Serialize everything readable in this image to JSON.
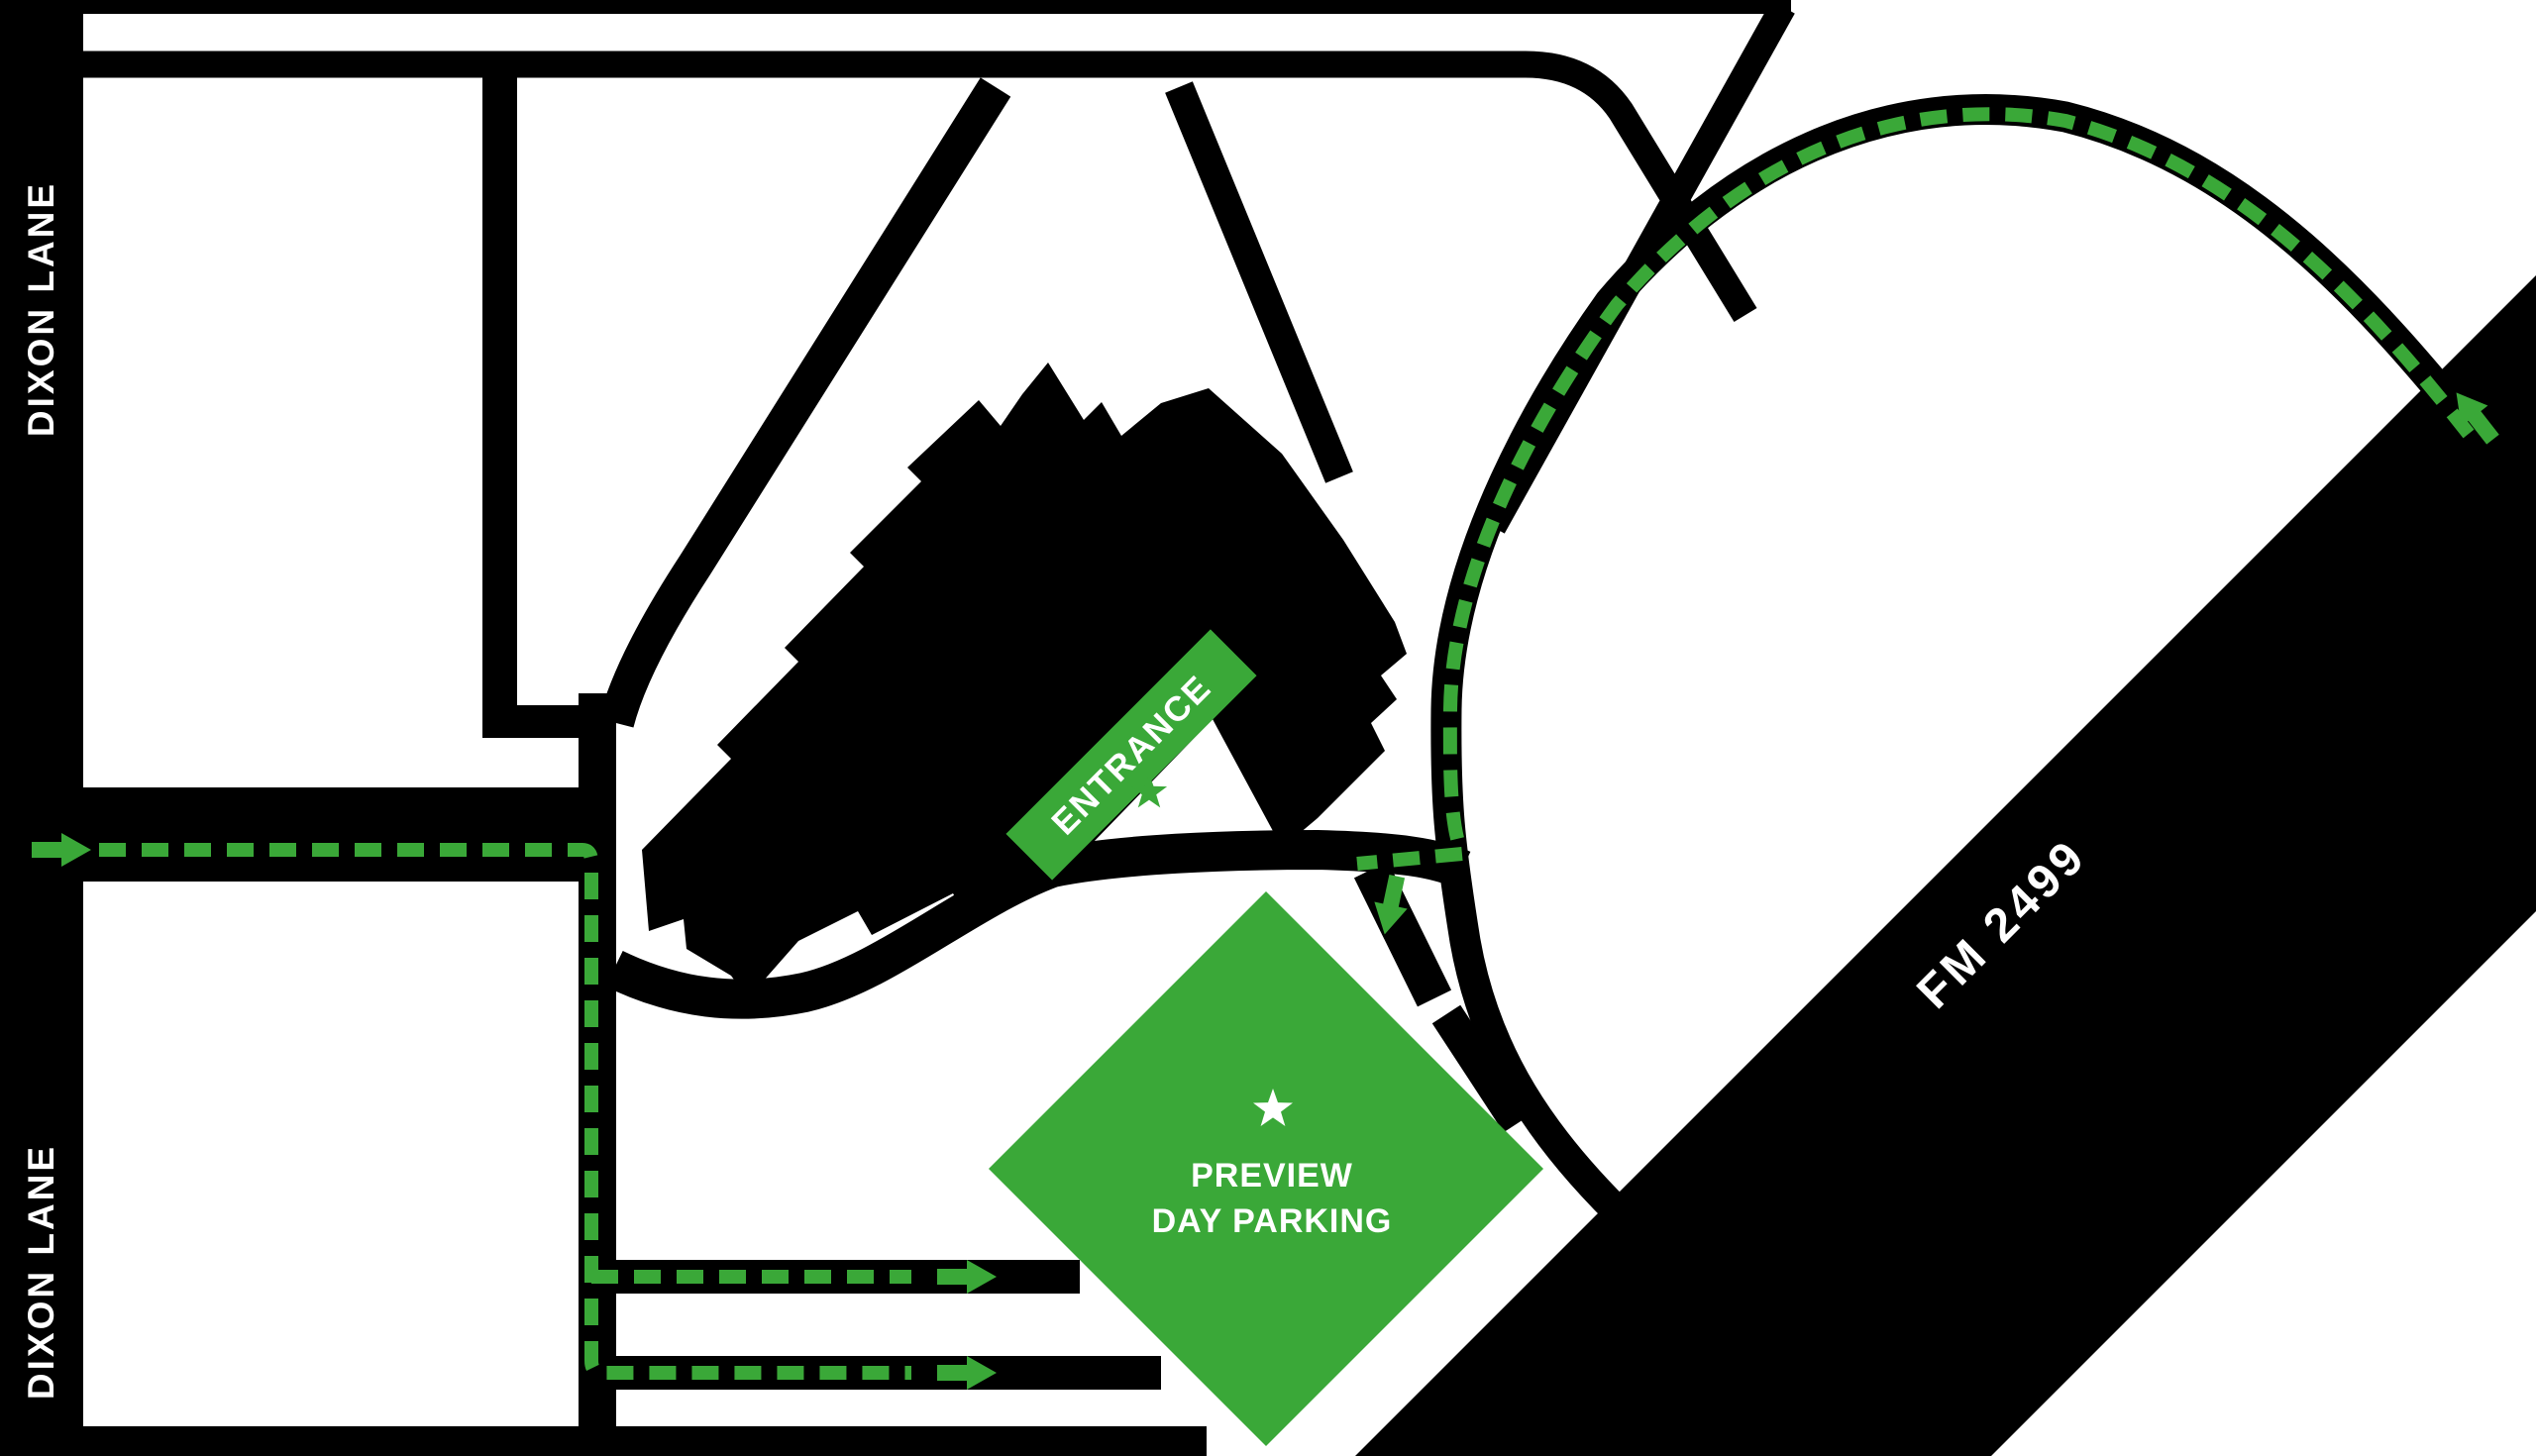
{
  "map": {
    "title": "Preview Day Parking directions map",
    "labels": {
      "dixon_lane": "DIXON LANE",
      "fm_2499": "FM 2499",
      "entrance": "ENTRANCE",
      "parking_line1": "PREVIEW",
      "parking_line2": "DAY PARKING"
    },
    "colors": {
      "green": "#3aa838",
      "black": "#000000",
      "white": "#ffffff"
    },
    "icons": {
      "route_arrows": [
        "route-arrow-west-entry",
        "route-arrow-lane-1",
        "route-arrow-lane-2",
        "route-arrow-fm2499-exit",
        "route-arrow-parking-entry"
      ],
      "markers": [
        "entrance-star-icon",
        "parking-star-icon"
      ]
    }
  }
}
